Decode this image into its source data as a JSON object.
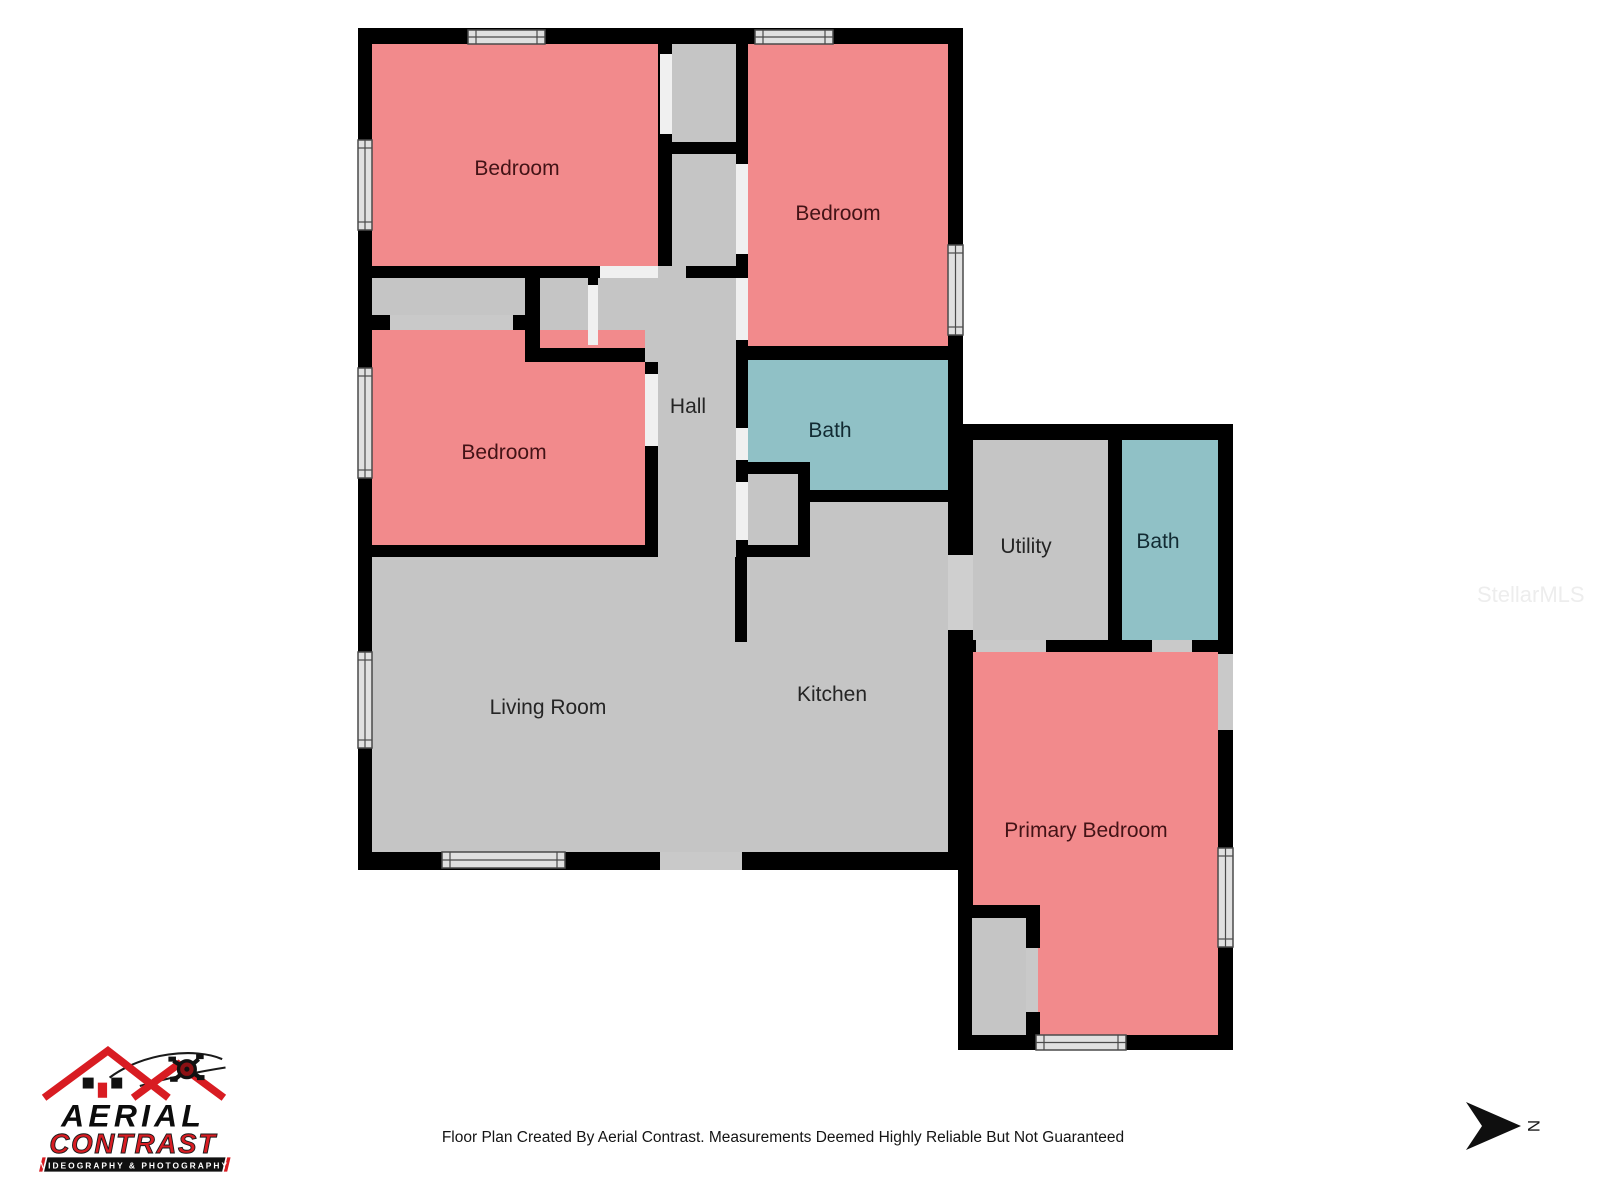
{
  "floor_plan": {
    "rooms": [
      {
        "id": "bedroom-top-left",
        "label": "Bedroom",
        "color_key": "room_bedroom"
      },
      {
        "id": "bedroom-top-right",
        "label": "Bedroom",
        "color_key": "room_bedroom"
      },
      {
        "id": "bedroom-middle",
        "label": "Bedroom",
        "color_key": "room_bedroom"
      },
      {
        "id": "hall",
        "label": "Hall",
        "color_key": "room_common"
      },
      {
        "id": "bath-main",
        "label": "Bath",
        "color_key": "room_bath"
      },
      {
        "id": "utility",
        "label": "Utility",
        "color_key": "room_common"
      },
      {
        "id": "bath-wing",
        "label": "Bath",
        "color_key": "room_bath"
      },
      {
        "id": "living-room",
        "label": "Living Room",
        "color_key": "room_common"
      },
      {
        "id": "kitchen",
        "label": "Kitchen",
        "color_key": "room_common"
      },
      {
        "id": "primary-bedroom",
        "label": "Primary Bedroom",
        "color_key": "room_bedroom"
      }
    ]
  },
  "logo": {
    "brand_line1": "AERIAL",
    "brand_line2": "CONTRAST",
    "tagline": "VIDEOGRAPHY & PHOTOGRAPHY"
  },
  "compass": {
    "north_label": "N"
  },
  "watermark": {
    "text": "StellarMLS"
  },
  "footer": {
    "disclaimer": "Floor Plan Created By Aerial Contrast. Measurements Deemed Highly Reliable But Not Guaranteed"
  },
  "colors": {
    "wall": "#000000",
    "room_common": "#c5c5c5",
    "room_bedroom": "#f28a8c",
    "room_bath": "#90c1c6",
    "window_fill": "#e0e0e0",
    "door_interior": "#f0f0f0",
    "door_exterior": "#c9c9c9",
    "opening": "#cfcfcf",
    "label_bedroom": "#431316",
    "label_common": "#252525",
    "label_bath": "#122b33",
    "logo_red": "#d81c22",
    "watermark": "#ededed",
    "footer": "#141414"
  }
}
